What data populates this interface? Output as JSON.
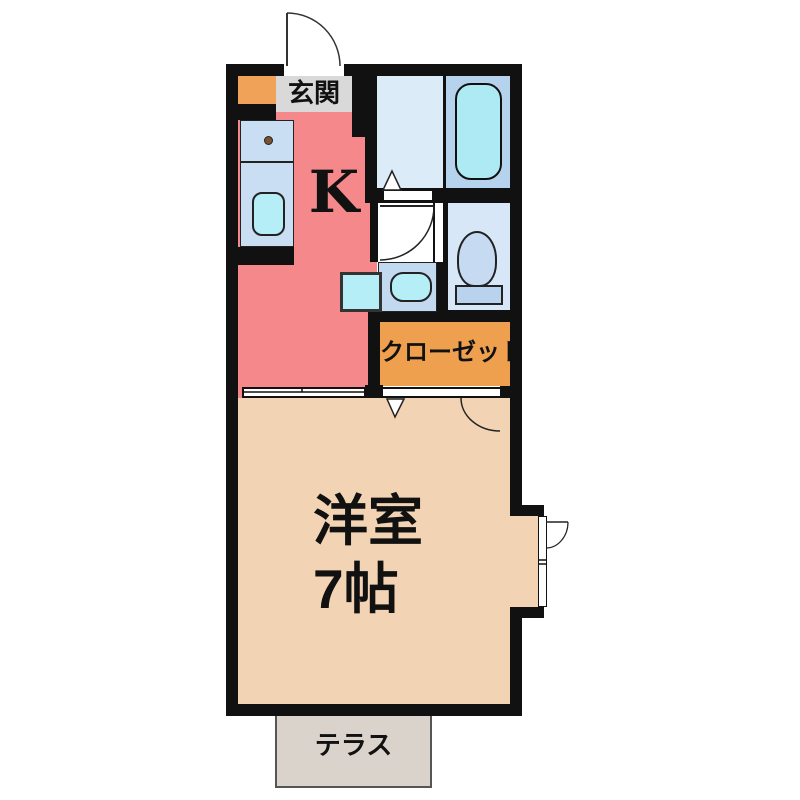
{
  "floorplan": {
    "type": "japanese-apartment-floorplan-1K",
    "rooms": {
      "genkan": {
        "label": "玄関"
      },
      "kitchen": {
        "label": "K"
      },
      "closet": {
        "label": "クローゼット"
      },
      "main_room": {
        "label_line1": "洋室",
        "label_line2": "7帖"
      },
      "terrace": {
        "label": "テラス"
      }
    },
    "fixtures": [
      "bathtub",
      "kitchen-counter",
      "kitchen-sink",
      "burner-dot",
      "washbasin",
      "washing-machine-pan",
      "toilet",
      "entrance-door",
      "washroom-door",
      "room-door",
      "folding-door-triangle",
      "sliding-door",
      "bay-door",
      "bay-window"
    ],
    "colors": {
      "bg": "#ffffff",
      "wall": "#111111",
      "kitchen": "#f4888b",
      "main-room": "#f2d3b3",
      "genkan-tile": "#f0a258",
      "genkan-floor": "#d9d9d9",
      "closet": "#efa04f",
      "bath-floor": "#dcebf8",
      "bath-tub-area": "#b6d3ee",
      "tub": "#aeeaf3",
      "counter": "#c9ddf3",
      "sink": "#b5eef7",
      "toilet-floor": "#d8e7f8",
      "toilet-bowl": "#c6daf2",
      "toilet-tank": "#b9d3ee",
      "basin-box": "#c3d9f0",
      "terrace": "#d9d3cb",
      "washroom-floor": "#ffffff",
      "burner-dot": "#7a5230"
    }
  }
}
